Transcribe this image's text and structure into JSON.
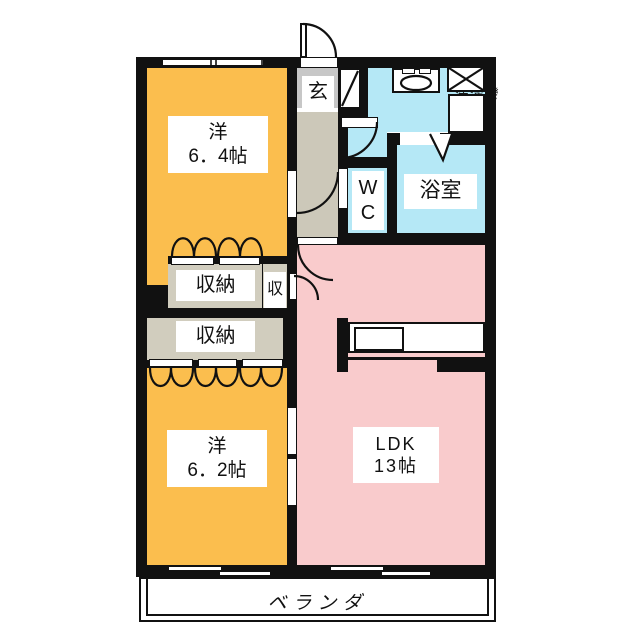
{
  "rooms": {
    "western_a": {
      "line1": "洋",
      "line2": "6．4帖"
    },
    "western_b": {
      "line1": "洋",
      "line2": "6．2帖"
    },
    "ldk": {
      "line1": "LDK",
      "line2": "13帖"
    },
    "bath": {
      "label": "浴室"
    },
    "wc": {
      "line1": "W",
      "line2": "C"
    },
    "entrance": {
      "label": "玄"
    },
    "laundry": {
      "label": "洗濯機"
    },
    "closet_upper": {
      "label": "収納"
    },
    "closet_lower": {
      "label": "収納"
    },
    "closet_small": {
      "label": "収"
    },
    "veranda": {
      "label": "ベランダ"
    }
  },
  "colors": {
    "room_orange": "#FBBE4E",
    "ldk_pink": "#F9CBCC",
    "wet_area_cyan": "#B5E8F6",
    "hall_beige": "#CCC8B9",
    "closet_beige": "#D1CDBE",
    "entry_gray": "#C7C7C7",
    "wall_black": "#111111"
  },
  "icons": {
    "sink": "sink-icon",
    "washing_machine": "washing-machine-icon",
    "washer_pan": "washer-pan-icon",
    "shoe_cabinet": "shoe-cabinet-icon",
    "kitchen_counter": "kitchen-counter-icon"
  }
}
